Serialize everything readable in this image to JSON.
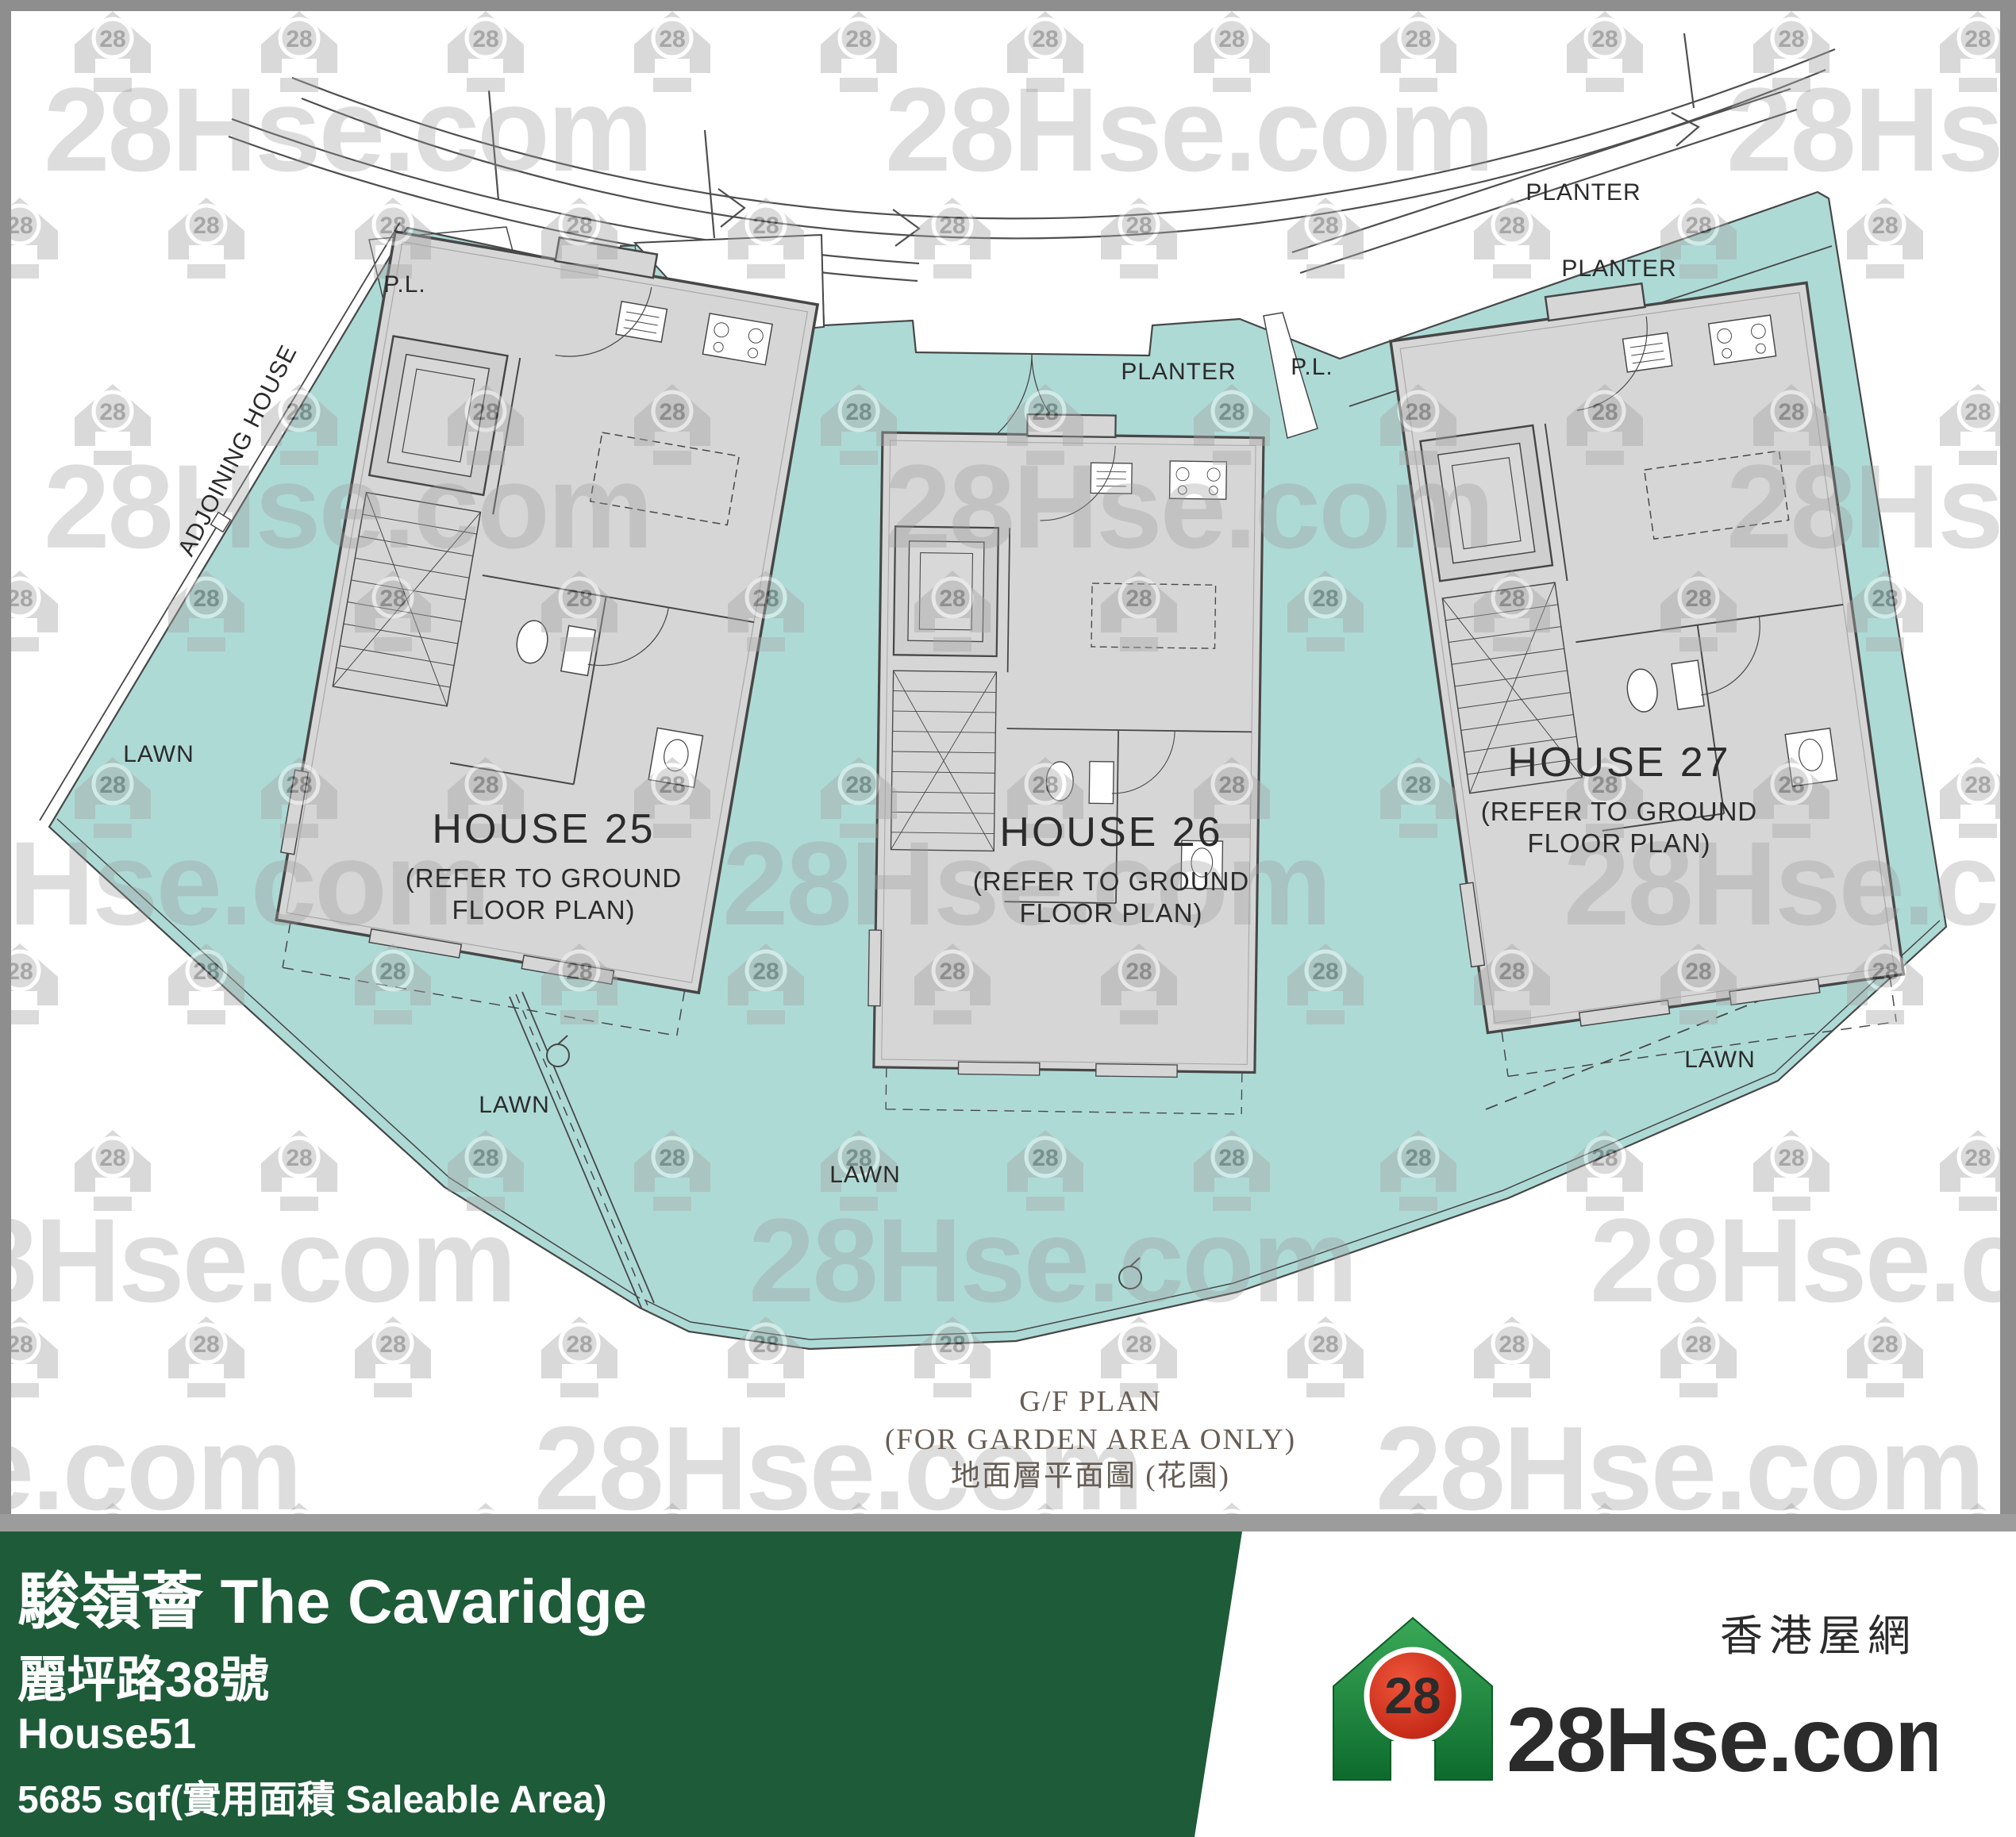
{
  "watermark": {
    "brand_text": "28Hse.com",
    "icon_text": "28"
  },
  "plan": {
    "houses": [
      {
        "name": "HOUSE 25",
        "note_line1": "(REFER TO GROUND",
        "note_line2": "FLOOR PLAN)"
      },
      {
        "name": "HOUSE 26",
        "note_line1": "(REFER TO GROUND",
        "note_line2": "FLOOR PLAN)"
      },
      {
        "name": "HOUSE 27",
        "note_line1": "(REFER TO GROUND",
        "note_line2": "FLOOR PLAN)"
      }
    ],
    "labels": {
      "pl_left": "P.L.",
      "pl_right": "P.L.",
      "planter_mid": "PLANTER",
      "planter_upper": "PLANTER",
      "planter_lower": "PLANTER",
      "lawn_left": "LAWN",
      "lawn_house25": "LAWN",
      "lawn_center": "LAWN",
      "lawn_right": "LAWN",
      "adjoining": "ADJOINING HOUSE"
    },
    "caption": {
      "line1": "G/F PLAN",
      "line2": "(FOR GARDEN AREA ONLY)",
      "line3": "地面層平面圖 (花園)"
    }
  },
  "footer": {
    "title": "駿嶺薈 The Cavaridge",
    "address": "麗坪路38號",
    "unit": "House51",
    "area": "5685 sqf(實用面積 Saleable Area)",
    "logo": {
      "badge": "28",
      "brand": "28Hse.com",
      "tagline": "香港屋網"
    }
  },
  "colors": {
    "garden_teal": "#aedad6",
    "house_fill": "#d6d6d6",
    "plan_line": "#474747",
    "banner_green": "#1e5b39",
    "logo_green": "#1e8a3c",
    "logo_red": "#cf2318",
    "watermark_gray": "#9a9a9a",
    "frame_gray": "#8e8e8e"
  }
}
